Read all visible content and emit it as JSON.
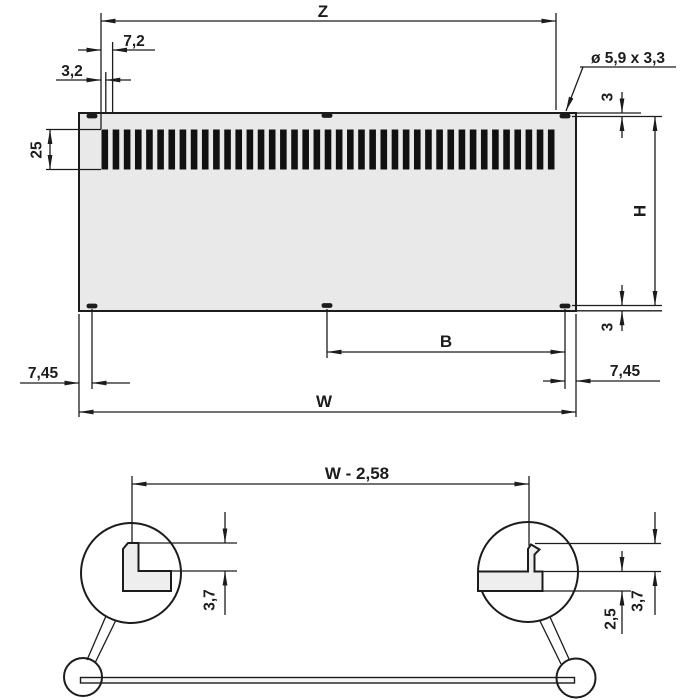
{
  "drawing": {
    "type": "technical-dimension-drawing",
    "views": {
      "front": {
        "dims": {
          "z": "Z",
          "slot_pitch": "7,2",
          "slot_width": "3,2",
          "hole_callout": "ø 5,9 x 3,3",
          "slot_height": "25",
          "hole_offset_top": "3",
          "height": "H",
          "hole_offset_bottom": "3",
          "edge_to_hole_left": "7,45",
          "edge_to_hole_right": "7,45",
          "hole_span": "B",
          "width": "W"
        },
        "slot_count": 41,
        "hole_count": 6
      },
      "detail": {
        "dims": {
          "tab_span": "W - 2,58",
          "tab_height_left": "3,7",
          "tab_height_right": "3,7",
          "panel_thickness": "2,5"
        }
      }
    },
    "colors": {
      "line": "#1c1c1c",
      "panel_fill": "#e9e9e9",
      "slot_fill": "#111111",
      "background": "#ffffff"
    }
  }
}
